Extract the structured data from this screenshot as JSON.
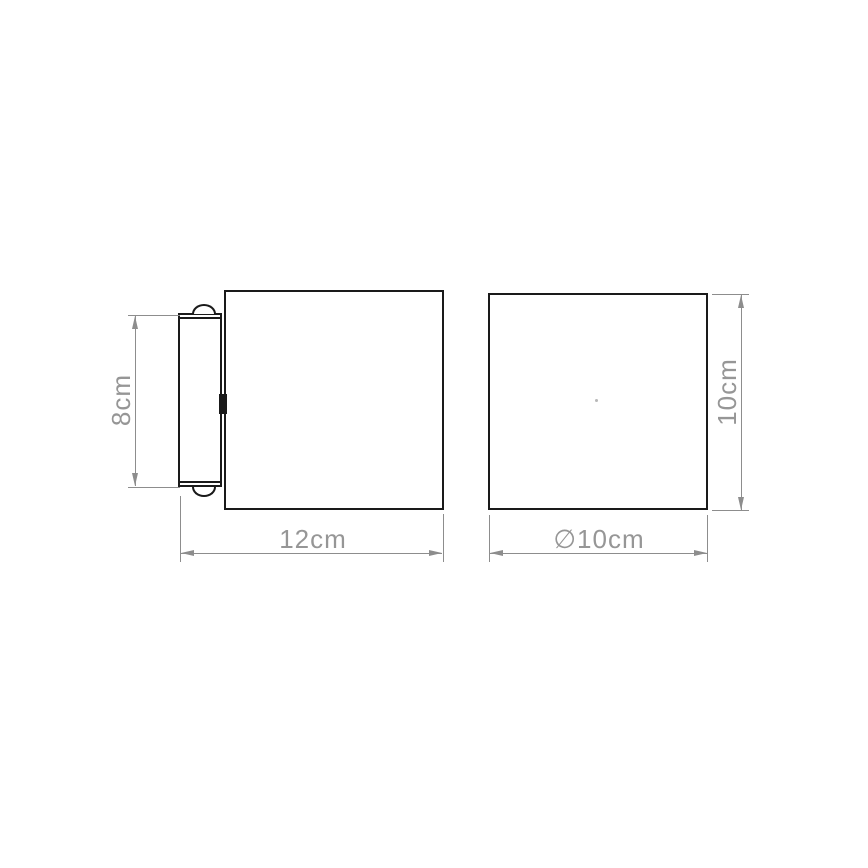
{
  "figure": {
    "type": "technical-dimension-drawing",
    "side_view": {
      "height_label": "8cm",
      "width_label": "12cm"
    },
    "front_view": {
      "height_label": "10cm",
      "diameter_label": "∅10cm"
    },
    "colors": {
      "outline": "#1a1a1a",
      "dimension_line": "#8d8d8d",
      "dimension_text": "#969696",
      "background": "#ffffff"
    }
  }
}
